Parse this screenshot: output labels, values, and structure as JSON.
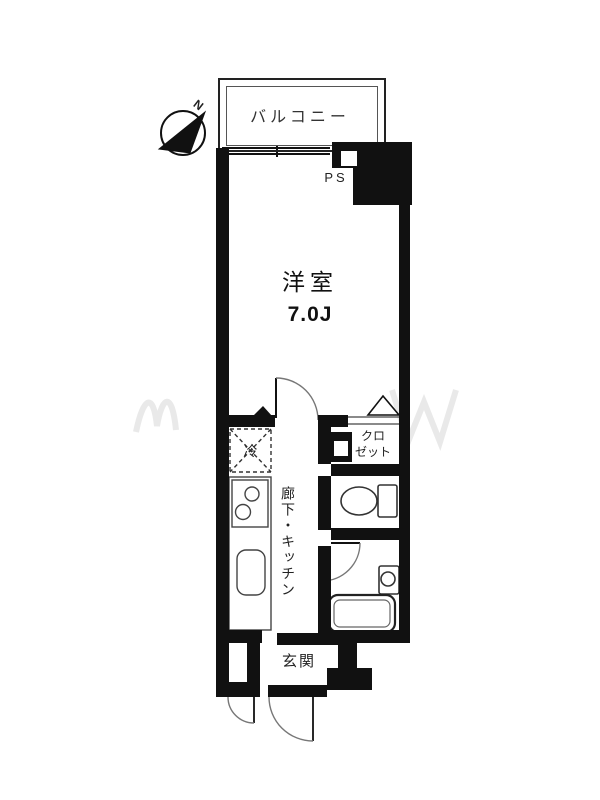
{
  "compass": {
    "north_label": "N"
  },
  "balcony": {
    "label": "バルコニー"
  },
  "pipe_space": {
    "label": "PS"
  },
  "main_room": {
    "name": "洋室",
    "size": "7.0J"
  },
  "kitchen": {
    "refrigerator_label": "冷",
    "hallway_kitchen_label": "廊下・キッチン"
  },
  "closet": {
    "label_line1": "クロ",
    "label_line2": "ゼット"
  },
  "entrance": {
    "label": "玄関"
  },
  "colors": {
    "wall": "#111111",
    "thin_line": "#444444",
    "text": "#222222",
    "watermark": "#e7e7e7"
  }
}
